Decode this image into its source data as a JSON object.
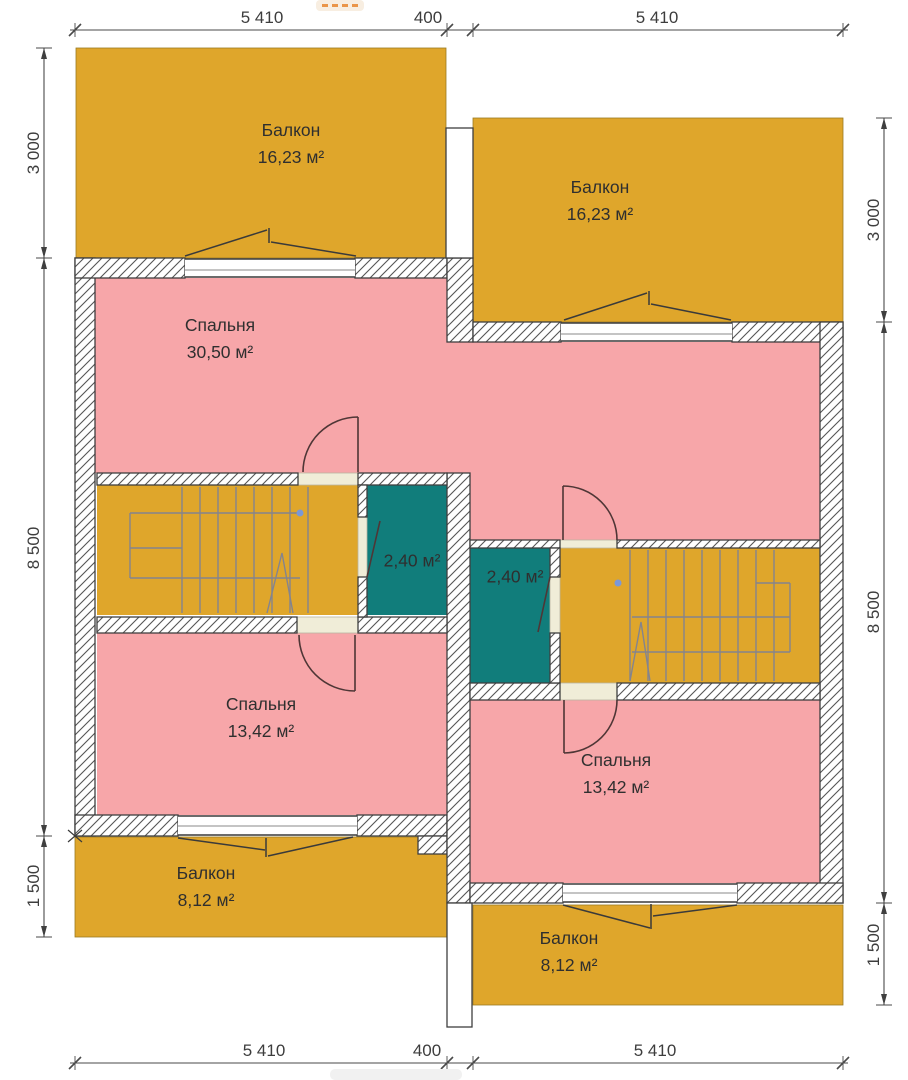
{
  "plan_title": "Second floor plan",
  "rooms": {
    "balcony_top_left": {
      "name": "Балкон",
      "area": "16,23 м²"
    },
    "balcony_top_right": {
      "name": "Балкон",
      "area": "16,23 м²"
    },
    "bedroom_top": {
      "name": "Спальня",
      "area": "30,50 м²"
    },
    "closet_left": {
      "area": "2,40 м²"
    },
    "closet_right": {
      "area": "2,40 м²"
    },
    "bedroom_bottom_left": {
      "name": "Спальня",
      "area": "13,42 м²"
    },
    "bedroom_bottom_right": {
      "name": "Спальня",
      "area": "13,42 м²"
    },
    "balcony_bottom_left": {
      "name": "Балкон",
      "area": "8,12 м²"
    },
    "balcony_bottom_right": {
      "name": "Балкон",
      "area": "8,12 м²"
    }
  },
  "dimensions": {
    "top": [
      "5 410",
      "400",
      "5 410"
    ],
    "bottom": [
      "5 410",
      "400",
      "5 410"
    ],
    "left": [
      "3 000",
      "8 500",
      "1 500"
    ],
    "right": [
      "3 000",
      "8 500",
      "1 500"
    ]
  },
  "colors": {
    "balcony_fill": "#dfa62b",
    "room_fill": "#f7a6a9",
    "wet_room_fill": "#117d7b",
    "threshold_fill": "#f0edd8",
    "wall_line": "#3f3f3f",
    "stair_line": "#84848e",
    "door_line": "#4f3636",
    "dim_text": "#3d3d3d"
  }
}
